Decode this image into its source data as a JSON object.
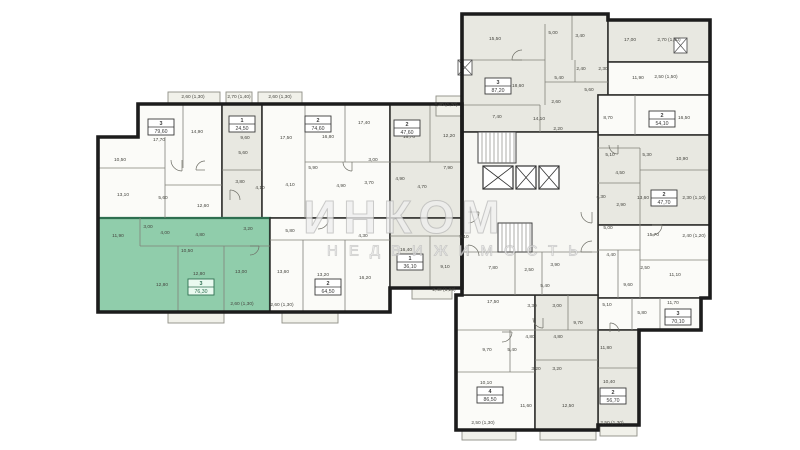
{
  "watermark": {
    "line1": "ИНКОМ",
    "line2": "НЕДВИЖИМОСТЬ"
  },
  "palette": {
    "wall": "#1c1c1c",
    "partition": "#82827a",
    "white_unit": "#fbfbf8",
    "shaded_unit": "#e8e8e1",
    "corridor": "#f7f7f3",
    "highlight_unit": "#90cdab",
    "highlight_wall": "#2e6f50",
    "balcony": "#f1f1ea",
    "label_text": "#45453f",
    "box_border": "#3a3a3a"
  },
  "units": [
    {
      "id": "u1",
      "number": "3",
      "area": "79,60",
      "box": [
        161,
        127
      ],
      "fill": "white",
      "poly": [
        [
          138,
          104
        ],
        [
          222,
          104
        ],
        [
          222,
          218
        ],
        [
          98,
          218
        ],
        [
          98,
          137
        ],
        [
          138,
          137
        ]
      ]
    },
    {
      "id": "u2",
      "number": "1",
      "area": "24,50",
      "box": [
        242,
        124
      ],
      "fill": "shaded",
      "poly": [
        [
          222,
          104
        ],
        [
          262,
          104
        ],
        [
          262,
          218
        ],
        [
          222,
          218
        ]
      ]
    },
    {
      "id": "u3",
      "number": "2",
      "area": "74,60",
      "box": [
        318,
        124
      ],
      "fill": "white",
      "poly": [
        [
          262,
          104
        ],
        [
          390,
          104
        ],
        [
          390,
          218
        ],
        [
          262,
          218
        ]
      ]
    },
    {
      "id": "u4",
      "number": "2",
      "area": "47,60",
      "box": [
        407,
        128
      ],
      "fill": "shaded",
      "poly": [
        [
          390,
          104
        ],
        [
          462,
          104
        ],
        [
          462,
          218
        ],
        [
          390,
          218
        ]
      ]
    },
    {
      "id": "u5",
      "number": "3",
      "area": "76,30",
      "box": [
        201,
        287
      ],
      "fill": "highlight",
      "poly": [
        [
          98,
          218
        ],
        [
          270,
          218
        ],
        [
          270,
          312
        ],
        [
          98,
          312
        ]
      ]
    },
    {
      "id": "u6",
      "number": "2",
      "area": "64,50",
      "box": [
        328,
        287
      ],
      "fill": "white",
      "poly": [
        [
          270,
          218
        ],
        [
          390,
          218
        ],
        [
          390,
          312
        ],
        [
          270,
          312
        ]
      ]
    },
    {
      "id": "u7",
      "number": "1",
      "area": "36,10",
      "box": [
        410,
        262
      ],
      "fill": "shaded",
      "poly": [
        [
          390,
          218
        ],
        [
          462,
          218
        ],
        [
          462,
          288
        ],
        [
          390,
          288
        ]
      ]
    },
    {
      "id": "u8",
      "number": "3",
      "area": "87,20",
      "box": [
        498,
        86
      ],
      "fill": "shaded",
      "poly": [
        [
          462,
          14
        ],
        [
          608,
          14
        ],
        [
          608,
          95
        ],
        [
          598,
          95
        ],
        [
          598,
          132
        ],
        [
          462,
          132
        ]
      ]
    },
    {
      "id": "u9",
      "fill": "shaded",
      "poly": [
        [
          608,
          20
        ],
        [
          710,
          20
        ],
        [
          710,
          62
        ],
        [
          608,
          62
        ]
      ]
    },
    {
      "id": "u10",
      "fill": "white",
      "poly": [
        [
          608,
          62
        ],
        [
          710,
          62
        ],
        [
          710,
          95
        ],
        [
          608,
          95
        ]
      ]
    },
    {
      "id": "u11",
      "number": "2",
      "area": "54,10",
      "box": [
        662,
        119
      ],
      "fill": "white",
      "poly": [
        [
          598,
          95
        ],
        [
          710,
          95
        ],
        [
          710,
          135
        ],
        [
          598,
          135
        ]
      ]
    },
    {
      "id": "u12",
      "number": "2",
      "area": "47,70",
      "box": [
        664,
        198
      ],
      "fill": "shaded",
      "poly": [
        [
          598,
          135
        ],
        [
          710,
          135
        ],
        [
          710,
          225
        ],
        [
          598,
          225
        ]
      ]
    },
    {
      "id": "u13",
      "fill": "white",
      "poly": [
        [
          598,
          225
        ],
        [
          710,
          225
        ],
        [
          710,
          298
        ],
        [
          598,
          298
        ]
      ]
    },
    {
      "id": "u14",
      "number": "3",
      "area": "70,10",
      "box": [
        678,
        317
      ],
      "fill": "white",
      "poly": [
        [
          598,
          298
        ],
        [
          701,
          298
        ],
        [
          701,
          330
        ],
        [
          598,
          330
        ]
      ]
    },
    {
      "id": "u15",
      "number": "2",
      "area": "56,70",
      "box": [
        613,
        396
      ],
      "fill": "shaded",
      "poly": [
        [
          598,
          330
        ],
        [
          639,
          330
        ],
        [
          639,
          425
        ],
        [
          598,
          425
        ]
      ]
    },
    {
      "id": "u16",
      "number": "4",
      "area": "86,50",
      "box": [
        490,
        395
      ],
      "fill": "white",
      "poly": [
        [
          456,
          295
        ],
        [
          535,
          295
        ],
        [
          535,
          430
        ],
        [
          456,
          430
        ]
      ]
    },
    {
      "id": "u17",
      "fill": "shaded",
      "poly": [
        [
          535,
          295
        ],
        [
          598,
          295
        ],
        [
          598,
          430
        ],
        [
          535,
          430
        ]
      ]
    },
    {
      "id": "core",
      "fill": "corridor",
      "poly": [
        [
          462,
          132
        ],
        [
          598,
          132
        ],
        [
          598,
          295
        ],
        [
          462,
          295
        ]
      ]
    }
  ],
  "envelope": [
    "M138,104 L462,104 L462,288 L390,288 L390,312 L98,312 L98,137 L138,137 Z",
    "M462,14 L608,14 L608,20 L710,20 L710,298 L701,298 L701,330 L639,330 L639,425 L598,425 L598,430 L456,430 L456,295 L462,295 Z"
  ],
  "room_labels": [
    {
      "t": "17,70",
      "x": 159,
      "y": 141
    },
    {
      "t": "14,90",
      "x": 197,
      "y": 133
    },
    {
      "t": "10,50",
      "x": 120,
      "y": 161
    },
    {
      "t": "13,10",
      "x": 123,
      "y": 196
    },
    {
      "t": "5,60",
      "x": 163,
      "y": 199
    },
    {
      "t": "12,60",
      "x": 203,
      "y": 207
    },
    {
      "t": "9,60",
      "x": 245,
      "y": 139
    },
    {
      "t": "5,60",
      "x": 243,
      "y": 154
    },
    {
      "t": "3,80",
      "x": 240,
      "y": 183
    },
    {
      "t": "4,10",
      "x": 260,
      "y": 189
    },
    {
      "t": "17,50",
      "x": 286,
      "y": 139
    },
    {
      "t": "16,80",
      "x": 328,
      "y": 138
    },
    {
      "t": "17,40",
      "x": 364,
      "y": 124
    },
    {
      "t": "5,90",
      "x": 313,
      "y": 169
    },
    {
      "t": "3,00",
      "x": 373,
      "y": 161
    },
    {
      "t": "4,10",
      "x": 290,
      "y": 186
    },
    {
      "t": "4,90",
      "x": 341,
      "y": 187
    },
    {
      "t": "3,70",
      "x": 369,
      "y": 184
    },
    {
      "t": "16,70",
      "x": 409,
      "y": 138
    },
    {
      "t": "12,20",
      "x": 449,
      "y": 137
    },
    {
      "t": "7,90",
      "x": 448,
      "y": 169
    },
    {
      "t": "4,90",
      "x": 400,
      "y": 180
    },
    {
      "t": "4,70",
      "x": 422,
      "y": 188
    },
    {
      "t": "2,40 (1,20)",
      "x": 446,
      "y": 106
    },
    {
      "t": "2,60 (1,30)",
      "x": 193,
      "y": 98
    },
    {
      "t": "2,70 (1,40)",
      "x": 239,
      "y": 98
    },
    {
      "t": "2,60 (1,30)",
      "x": 280,
      "y": 98
    },
    {
      "t": "11,90",
      "x": 118,
      "y": 237
    },
    {
      "t": "3,00",
      "x": 148,
      "y": 228
    },
    {
      "t": "4,00",
      "x": 165,
      "y": 234
    },
    {
      "t": "4,80",
      "x": 200,
      "y": 236
    },
    {
      "t": "3,20",
      "x": 248,
      "y": 230
    },
    {
      "t": "10,50",
      "x": 187,
      "y": 252
    },
    {
      "t": "12,80",
      "x": 162,
      "y": 286
    },
    {
      "t": "12,80",
      "x": 199,
      "y": 275
    },
    {
      "t": "13,00",
      "x": 241,
      "y": 273
    },
    {
      "t": "2,60 (1,30)",
      "x": 242,
      "y": 305
    },
    {
      "t": "5,80",
      "x": 290,
      "y": 232
    },
    {
      "t": "4,30",
      "x": 363,
      "y": 237
    },
    {
      "t": "13,60",
      "x": 283,
      "y": 273
    },
    {
      "t": "13,20",
      "x": 323,
      "y": 276
    },
    {
      "t": "16,20",
      "x": 365,
      "y": 279
    },
    {
      "t": "2,60 (1,30)",
      "x": 282,
      "y": 306
    },
    {
      "t": "16,40",
      "x": 406,
      "y": 251
    },
    {
      "t": "9,10",
      "x": 445,
      "y": 268
    },
    {
      "t": "5,10",
      "x": 464,
      "y": 238
    },
    {
      "t": "2,40 (1,20)",
      "x": 444,
      "y": 291
    },
    {
      "t": "15,50",
      "x": 495,
      "y": 40
    },
    {
      "t": "5,00",
      "x": 553,
      "y": 34
    },
    {
      "t": "3,40",
      "x": 580,
      "y": 37
    },
    {
      "t": "18,60",
      "x": 518,
      "y": 87
    },
    {
      "t": "5,40",
      "x": 559,
      "y": 79
    },
    {
      "t": "2,40",
      "x": 581,
      "y": 70
    },
    {
      "t": "2,30",
      "x": 603,
      "y": 70
    },
    {
      "t": "5,60",
      "x": 589,
      "y": 91
    },
    {
      "t": "2,60",
      "x": 556,
      "y": 103
    },
    {
      "t": "7,40",
      "x": 497,
      "y": 118
    },
    {
      "t": "14,10",
      "x": 539,
      "y": 120
    },
    {
      "t": "2,20",
      "x": 558,
      "y": 130
    },
    {
      "t": "17,00",
      "x": 630,
      "y": 41
    },
    {
      "t": "2,70 (1,40)",
      "x": 669,
      "y": 41
    },
    {
      "t": "11,90",
      "x": 638,
      "y": 79
    },
    {
      "t": "2,50 (1,50)",
      "x": 666,
      "y": 78
    },
    {
      "t": "16,50",
      "x": 684,
      "y": 119
    },
    {
      "t": "8,70",
      "x": 608,
      "y": 119
    },
    {
      "t": "5,10",
      "x": 610,
      "y": 156
    },
    {
      "t": "5,30",
      "x": 647,
      "y": 156
    },
    {
      "t": "10,90",
      "x": 682,
      "y": 160
    },
    {
      "t": "4,50",
      "x": 620,
      "y": 174
    },
    {
      "t": "4,30",
      "x": 601,
      "y": 198
    },
    {
      "t": "2,90",
      "x": 621,
      "y": 206
    },
    {
      "t": "13,60",
      "x": 643,
      "y": 199
    },
    {
      "t": "2,30 (1,10)",
      "x": 694,
      "y": 199
    },
    {
      "t": "5,00",
      "x": 608,
      "y": 229
    },
    {
      "t": "15,70",
      "x": 653,
      "y": 236
    },
    {
      "t": "2,40 (1,20)",
      "x": 694,
      "y": 237
    },
    {
      "t": "4,40",
      "x": 611,
      "y": 256
    },
    {
      "t": "2,50",
      "x": 645,
      "y": 269
    },
    {
      "t": "11,10",
      "x": 675,
      "y": 276
    },
    {
      "t": "9,60",
      "x": 628,
      "y": 286
    },
    {
      "t": "5,10",
      "x": 607,
      "y": 306
    },
    {
      "t": "11,70",
      "x": 673,
      "y": 304
    },
    {
      "t": "5,80",
      "x": 642,
      "y": 314
    },
    {
      "t": "11,80",
      "x": 606,
      "y": 349
    },
    {
      "t": "10,40",
      "x": 609,
      "y": 383
    },
    {
      "t": "2,50 (1,30)",
      "x": 612,
      "y": 424
    },
    {
      "t": "17,50",
      "x": 493,
      "y": 303
    },
    {
      "t": "3,30",
      "x": 532,
      "y": 307
    },
    {
      "t": "9,70",
      "x": 487,
      "y": 351
    },
    {
      "t": "5,40",
      "x": 512,
      "y": 351
    },
    {
      "t": "4,80",
      "x": 530,
      "y": 338
    },
    {
      "t": "10,10",
      "x": 486,
      "y": 384
    },
    {
      "t": "11,60",
      "x": 526,
      "y": 407
    },
    {
      "t": "2,50 (1,30)",
      "x": 483,
      "y": 424
    },
    {
      "t": "3,00",
      "x": 557,
      "y": 307
    },
    {
      "t": "9,70",
      "x": 578,
      "y": 324
    },
    {
      "t": "4,80",
      "x": 558,
      "y": 338
    },
    {
      "t": "3,20",
      "x": 536,
      "y": 370
    },
    {
      "t": "3,20",
      "x": 557,
      "y": 370
    },
    {
      "t": "12,50",
      "x": 568,
      "y": 407
    },
    {
      "t": "7,80",
      "x": 493,
      "y": 269
    },
    {
      "t": "2,50",
      "x": 529,
      "y": 271
    },
    {
      "t": "3,90",
      "x": 555,
      "y": 266
    },
    {
      "t": "5,40",
      "x": 545,
      "y": 287
    }
  ],
  "partitions": [
    [
      183,
      104,
      183,
      168
    ],
    [
      165,
      137,
      165,
      218
    ],
    [
      98,
      168,
      165,
      168
    ],
    [
      165,
      185,
      222,
      185
    ],
    [
      222,
      170,
      262,
      170
    ],
    [
      305,
      104,
      305,
      218
    ],
    [
      345,
      104,
      345,
      162
    ],
    [
      305,
      162,
      390,
      162
    ],
    [
      390,
      162,
      462,
      162
    ],
    [
      430,
      104,
      430,
      162
    ],
    [
      140,
      218,
      140,
      246
    ],
    [
      140,
      246,
      270,
      246
    ],
    [
      178,
      246,
      178,
      312
    ],
    [
      224,
      246,
      224,
      312
    ],
    [
      270,
      240,
      390,
      240
    ],
    [
      303,
      240,
      303,
      312
    ],
    [
      345,
      240,
      345,
      312
    ],
    [
      390,
      236,
      462,
      236
    ],
    [
      430,
      236,
      430,
      288
    ],
    [
      462,
      60,
      545,
      60
    ],
    [
      545,
      24,
      545,
      60
    ],
    [
      572,
      14,
      572,
      60
    ],
    [
      462,
      105,
      540,
      105
    ],
    [
      540,
      105,
      540,
      132
    ],
    [
      545,
      60,
      545,
      105
    ],
    [
      575,
      60,
      575,
      82
    ],
    [
      545,
      82,
      608,
      82
    ],
    [
      635,
      95,
      635,
      135
    ],
    [
      598,
      148,
      640,
      148
    ],
    [
      640,
      148,
      640,
      225
    ],
    [
      640,
      170,
      710,
      170
    ],
    [
      598,
      183,
      640,
      183
    ],
    [
      598,
      250,
      640,
      250
    ],
    [
      640,
      225,
      640,
      298
    ],
    [
      640,
      260,
      710,
      260
    ],
    [
      618,
      250,
      618,
      298
    ],
    [
      632,
      298,
      632,
      330
    ],
    [
      660,
      298,
      660,
      330
    ],
    [
      598,
      368,
      639,
      368
    ],
    [
      456,
      330,
      535,
      330
    ],
    [
      510,
      330,
      510,
      372
    ],
    [
      456,
      372,
      535,
      372
    ],
    [
      535,
      330,
      598,
      330
    ],
    [
      535,
      360,
      598,
      360
    ],
    [
      568,
      295,
      568,
      330
    ],
    [
      462,
      252,
      598,
      252
    ],
    [
      515,
      252,
      515,
      295
    ],
    [
      542,
      252,
      542,
      295
    ]
  ],
  "balconies": [
    [
      168,
      92,
      52,
      12
    ],
    [
      226,
      92,
      26,
      12
    ],
    [
      258,
      92,
      44,
      12
    ],
    [
      436,
      96,
      26,
      20
    ],
    [
      168,
      312,
      56,
      11
    ],
    [
      282,
      312,
      56,
      11
    ],
    [
      412,
      288,
      40,
      11
    ],
    [
      462,
      430,
      54,
      10
    ],
    [
      540,
      430,
      56,
      10
    ],
    [
      600,
      425,
      37,
      11
    ]
  ],
  "core": {
    "stairs": [
      [
        478,
        132,
        38,
        31
      ],
      [
        498,
        223,
        34,
        29
      ]
    ],
    "elevators": [
      [
        483,
        166,
        30,
        23
      ],
      [
        516,
        166,
        20,
        23
      ],
      [
        539,
        166,
        20,
        23
      ]
    ],
    "facade_boxes": [
      [
        458,
        60,
        14,
        15
      ],
      [
        674,
        38,
        13,
        15
      ]
    ]
  },
  "doors": [
    [
      182,
      160,
      11,
      1
    ],
    [
      230,
      200,
      10,
      3
    ],
    [
      318,
      218,
      11,
      0
    ],
    [
      352,
      162,
      9,
      1
    ],
    [
      468,
      212,
      11,
      0
    ],
    [
      468,
      256,
      11,
      3
    ],
    [
      592,
      212,
      11,
      1
    ],
    [
      592,
      252,
      11,
      2
    ],
    [
      618,
      145,
      9,
      1
    ],
    [
      652,
      225,
      10,
      0
    ],
    [
      543,
      318,
      10,
      1
    ],
    [
      502,
      332,
      10,
      0
    ],
    [
      610,
      332,
      9,
      3
    ],
    [
      522,
      60,
      10,
      2
    ],
    [
      250,
      246,
      9,
      0
    ],
    [
      205,
      170,
      9,
      2
    ]
  ]
}
